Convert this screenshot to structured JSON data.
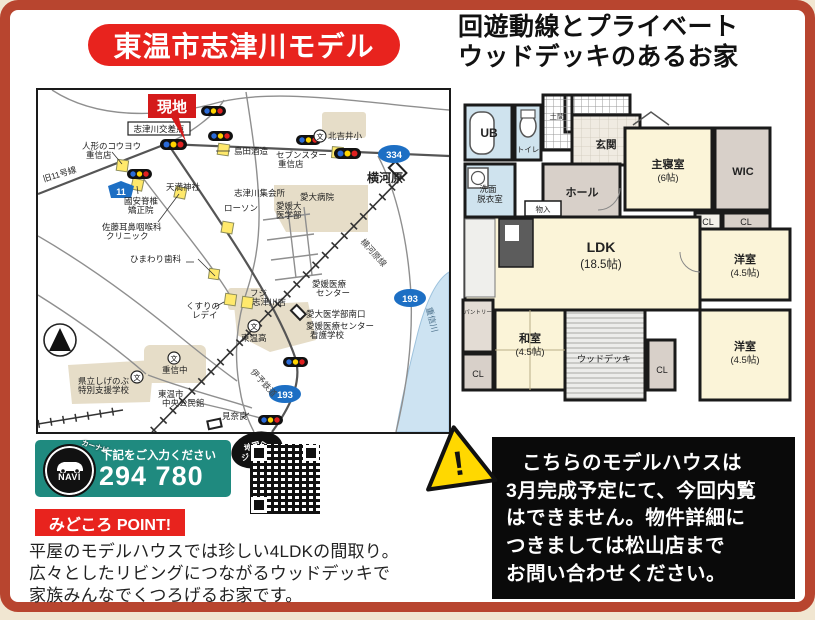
{
  "title": "東温市志津川モデル",
  "headline": {
    "line1": "回遊動線とプライベート",
    "line2": "ウッドデッキのあるお家"
  },
  "colors": {
    "banner_red": "#e8231e",
    "frame_red": "#b8452f",
    "navi_teal": "#1f8a7f",
    "map_building_beige": "#e6ddc8",
    "river_blue": "#cde3f2",
    "plan_cream": "#fbf4d8",
    "plan_blue": "#cfe3ee",
    "plan_gray": "#d8d0c9",
    "signal_blue": "#2b6bd8",
    "signal_yellow": "#ffd400",
    "signal_red": "#e02020",
    "route_blue": "#1d6fc4"
  },
  "map": {
    "site_flag": "現地",
    "intersection": "志津川交差点",
    "labels": {
      "shimada": "島田酒造",
      "ningyo1": "人形のコウヨウ",
      "ningyo2": "重信店",
      "kyu11": "旧11号線",
      "kuniyasu1": "國安脊椎",
      "kuniyasu2": "矯正院",
      "tenma": "天満神社",
      "sato1": "佐藤耳鼻咽喉科",
      "sato2": "クリニック",
      "himawari": "ひまわり歯科",
      "shukaijo": "志津川集会所",
      "lawson": "ローソン",
      "seven1": "セブンスター",
      "seven2": "重信店",
      "kitayoshii": "北吉井小",
      "yokogawara": "横河原",
      "aidai_byoin": "愛大病院",
      "ehimedai1": "愛媛大",
      "ehimedai2": "医学部",
      "fuji1": "フジ",
      "fuji2": "志津川店",
      "kusuri1": "くすりの",
      "kusuri2": "レデイ",
      "toonko": "東温高",
      "iryo1": "愛媛医療",
      "iryo2": "センター",
      "aidai_minami": "愛大医学部南口",
      "kango1": "愛媛医療センター",
      "kango2": "看護学校",
      "shigenobu_chu": "重信中",
      "shien1": "県立しげのぶ",
      "shien2": "特別支援学校",
      "kominkan1": "東温市",
      "kominkan2": "中央公民館",
      "minara": "見奈良",
      "river": "重信川",
      "rail1": "横河原線",
      "rail2": "伊予鉄道",
      "school_mark": "文"
    },
    "shields": {
      "r11": "11",
      "r334": "334",
      "r193a": "193",
      "r193b": "193"
    }
  },
  "floorplan": {
    "rooms": {
      "ub": "UB",
      "toilet": "トイレ",
      "doma": "土間",
      "genkan": "玄関",
      "senmen1": "洗面",
      "senmen2": "脱衣室",
      "hall": "ホール",
      "monoire": "物入",
      "shushin1": "主寝室",
      "shushin2": "(6帖)",
      "wic": "WIC",
      "cl1": "CL",
      "cl2": "CL",
      "cl3": "CL",
      "cl4": "CL",
      "ldk1": "LDK",
      "ldk2": "(18.5帖)",
      "yo_top1": "洋室",
      "yo_top2": "(4.5帖)",
      "yo_btm1": "洋室",
      "yo_btm2": "(4.5帖)",
      "washitsu1": "和室",
      "washitsu2": "(4.5帖)",
      "deck": "ウッドデッキ",
      "pantry": "パントリー"
    }
  },
  "navi": {
    "navi_word": "NAVI",
    "carnavi": "カーナビ",
    "instruction": "下記をご入力ください",
    "mapcode": "294 780 210",
    "jump1": "地図へ",
    "jump2": "ジャンプ!"
  },
  "point": {
    "badge": "みどころ POINT!",
    "line1": "平屋のモデルハウスでは珍しい4LDKの間取り。",
    "line2": "広々としたリビングにつながるウッドデッキで",
    "line3": "家族みんなでくつろげるお家です。"
  },
  "notice": {
    "warning_mark": "!",
    "line1": "こちらのモデルハウスは",
    "line2": "3月完成予定にて、今回内覧",
    "line3": "はできません。物件詳細に",
    "line4": "つきましては松山店まで",
    "line5": "お問い合わせください。"
  }
}
